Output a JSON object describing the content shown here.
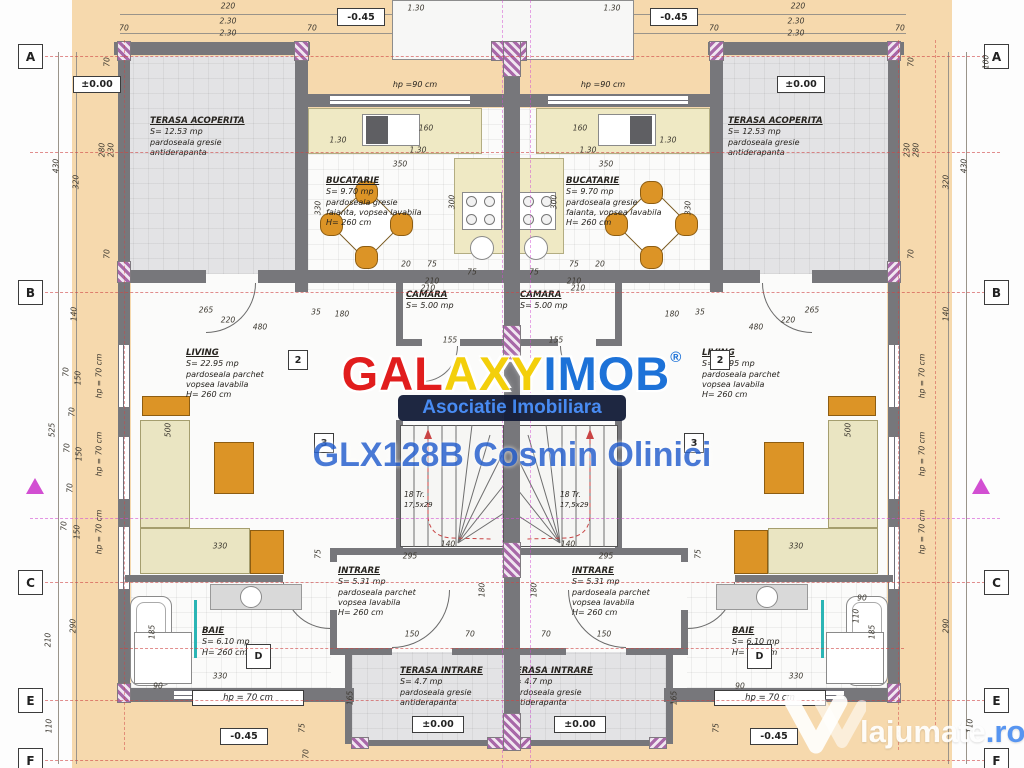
{
  "plan": {
    "rooms": {
      "terasa_acoperita": {
        "name": "TERASA ACOPERITA",
        "area": "S= 12.53 mp",
        "note1": "pardoseala gresie",
        "note2": "antiderapanta"
      },
      "bucatarie": {
        "name": "BUCATARIE",
        "area": "S= 9.70 mp",
        "note1": "pardoseala gresie",
        "note2": "faianta, vopsea lavabila",
        "note3": "H= 260 cm"
      },
      "camara": {
        "name": "CAMARA",
        "area": "S= 5.00 mp"
      },
      "living": {
        "name": "LIVING",
        "area": "S= 22.95 mp",
        "note1": "pardoseala parchet",
        "note2": "vopsea lavabila",
        "note3": "H= 260 cm"
      },
      "intrare": {
        "name": "INTRARE",
        "area": "S= 5.31 mp",
        "note1": "pardoseala parchet",
        "note2": "vopsea lavabila",
        "note3": "H= 260 cm"
      },
      "baie": {
        "name": "BAIE",
        "area": "S= 6.10 mp",
        "note1": "H= 260 cm"
      },
      "terasa_intrare": {
        "name": "TERASA INTRARE",
        "area": "S= 4.7 mp",
        "note1": "pardoseala gresie",
        "note2": "antiderapanta"
      }
    },
    "stairs": {
      "steps": "18 Tr.",
      "riser": "17,5x29"
    },
    "elevations": {
      "zero": "±0.00",
      "minus": "-0.45"
    },
    "sills": {
      "hp90": "hp =90 cm",
      "hp70": "hp = 70 cm"
    },
    "grid": {
      "left": [
        "A",
        "B",
        "C",
        "E",
        "F"
      ],
      "right": [
        "A",
        "B",
        "C",
        "E",
        "F"
      ],
      "bath": "D"
    },
    "markers": {
      "m2": "2",
      "m3": "3"
    },
    "dimensions": [
      {
        "t": "220",
        "x": 228,
        "y": 6
      },
      {
        "t": "70",
        "x": 124,
        "y": 28
      },
      {
        "t": "2.30",
        "x": 228,
        "y": 21
      },
      {
        "t": "2.30",
        "x": 228,
        "y": 33
      },
      {
        "t": "70",
        "x": 312,
        "y": 28
      },
      {
        "t": "1.30",
        "x": 416,
        "y": 8
      },
      {
        "t": "1.30",
        "x": 612,
        "y": 8
      },
      {
        "t": "70",
        "x": 714,
        "y": 28
      },
      {
        "t": "2.30",
        "x": 796,
        "y": 21
      },
      {
        "t": "2.30",
        "x": 796,
        "y": 33
      },
      {
        "t": "70",
        "x": 900,
        "y": 28
      },
      {
        "t": "220",
        "x": 798,
        "y": 6
      },
      {
        "t": "430",
        "x": 56,
        "y": 166,
        "r": 1
      },
      {
        "t": "320",
        "x": 76,
        "y": 182,
        "r": 1
      },
      {
        "t": "280",
        "x": 102,
        "y": 150,
        "r": 1
      },
      {
        "t": "230",
        "x": 111,
        "y": 150,
        "r": 1
      },
      {
        "t": "70",
        "x": 107,
        "y": 62,
        "r": 1
      },
      {
        "t": "70",
        "x": 107,
        "y": 254,
        "r": 1
      },
      {
        "t": "140",
        "x": 74,
        "y": 314,
        "r": 1
      },
      {
        "t": "70",
        "x": 66,
        "y": 372,
        "r": 1
      },
      {
        "t": "150",
        "x": 78,
        "y": 378,
        "r": 1
      },
      {
        "t": "70",
        "x": 72,
        "y": 412,
        "r": 1
      },
      {
        "t": "525",
        "x": 52,
        "y": 430,
        "r": 1
      },
      {
        "t": "70",
        "x": 67,
        "y": 448,
        "r": 1
      },
      {
        "t": "150",
        "x": 79,
        "y": 454,
        "r": 1
      },
      {
        "t": "70",
        "x": 70,
        "y": 488,
        "r": 1
      },
      {
        "t": "70",
        "x": 64,
        "y": 526,
        "r": 1
      },
      {
        "t": "150",
        "x": 77,
        "y": 532,
        "r": 1
      },
      {
        "t": "210",
        "x": 48,
        "y": 640,
        "r": 1
      },
      {
        "t": "290",
        "x": 73,
        "y": 626,
        "r": 1
      },
      {
        "t": "110",
        "x": 49,
        "y": 726,
        "r": 1
      },
      {
        "t": "hp = 70 cm",
        "x": 99,
        "y": 376,
        "r": 1
      },
      {
        "t": "hp = 70 cm",
        "x": 99,
        "y": 454,
        "r": 1
      },
      {
        "t": "hp = 70 cm",
        "x": 99,
        "y": 532,
        "r": 1
      },
      {
        "t": "100",
        "x": 986,
        "y": 62,
        "r": 1
      },
      {
        "t": "430",
        "x": 964,
        "y": 166,
        "r": 1
      },
      {
        "t": "320",
        "x": 946,
        "y": 182,
        "r": 1
      },
      {
        "t": "280",
        "x": 916,
        "y": 150,
        "r": 1
      },
      {
        "t": "230",
        "x": 907,
        "y": 150,
        "r": 1
      },
      {
        "t": "70",
        "x": 911,
        "y": 62,
        "r": 1
      },
      {
        "t": "70",
        "x": 911,
        "y": 254,
        "r": 1
      },
      {
        "t": "140",
        "x": 946,
        "y": 314,
        "r": 1
      },
      {
        "t": "290",
        "x": 946,
        "y": 626,
        "r": 1
      },
      {
        "t": "110",
        "x": 970,
        "y": 726,
        "r": 1
      },
      {
        "t": "hp = 70 cm",
        "x": 922,
        "y": 376,
        "r": 1
      },
      {
        "t": "hp = 70 cm",
        "x": 922,
        "y": 454,
        "r": 1
      },
      {
        "t": "hp = 70 cm",
        "x": 922,
        "y": 532,
        "r": 1
      },
      {
        "t": "1.30",
        "x": 338,
        "y": 140
      },
      {
        "t": "160",
        "x": 426,
        "y": 128
      },
      {
        "t": "1.30",
        "x": 418,
        "y": 150
      },
      {
        "t": "350",
        "x": 400,
        "y": 164
      },
      {
        "t": "300",
        "x": 452,
        "y": 202,
        "r": 1
      },
      {
        "t": "330",
        "x": 318,
        "y": 208,
        "r": 1
      },
      {
        "t": "20",
        "x": 406,
        "y": 264
      },
      {
        "t": "75",
        "x": 432,
        "y": 264
      },
      {
        "t": "75",
        "x": 472,
        "y": 272
      },
      {
        "t": "210",
        "x": 432,
        "y": 281
      },
      {
        "t": "1.30",
        "x": 668,
        "y": 140
      },
      {
        "t": "160",
        "x": 580,
        "y": 128
      },
      {
        "t": "1.30",
        "x": 588,
        "y": 150
      },
      {
        "t": "350",
        "x": 606,
        "y": 164
      },
      {
        "t": "300",
        "x": 554,
        "y": 202,
        "r": 1
      },
      {
        "t": "330",
        "x": 688,
        "y": 208,
        "r": 1
      },
      {
        "t": "20",
        "x": 600,
        "y": 264
      },
      {
        "t": "75",
        "x": 574,
        "y": 264
      },
      {
        "t": "75",
        "x": 534,
        "y": 272
      },
      {
        "t": "210",
        "x": 574,
        "y": 281
      },
      {
        "t": "210",
        "x": 428,
        "y": 288
      },
      {
        "t": "155",
        "x": 450,
        "y": 340
      },
      {
        "t": "210",
        "x": 578,
        "y": 288
      },
      {
        "t": "155",
        "x": 556,
        "y": 340
      },
      {
        "t": "265",
        "x": 206,
        "y": 310
      },
      {
        "t": "220",
        "x": 228,
        "y": 320
      },
      {
        "t": "480",
        "x": 260,
        "y": 327
      },
      {
        "t": "35",
        "x": 316,
        "y": 312
      },
      {
        "t": "180",
        "x": 342,
        "y": 314
      },
      {
        "t": "500",
        "x": 168,
        "y": 430,
        "r": 1
      },
      {
        "t": "330",
        "x": 220,
        "y": 546
      },
      {
        "t": "75",
        "x": 318,
        "y": 554,
        "r": 1
      },
      {
        "t": "265",
        "x": 812,
        "y": 310
      },
      {
        "t": "220",
        "x": 788,
        "y": 320
      },
      {
        "t": "480",
        "x": 756,
        "y": 327
      },
      {
        "t": "35",
        "x": 700,
        "y": 312
      },
      {
        "t": "180",
        "x": 672,
        "y": 314
      },
      {
        "t": "500",
        "x": 848,
        "y": 430,
        "r": 1
      },
      {
        "t": "330",
        "x": 796,
        "y": 546
      },
      {
        "t": "75",
        "x": 698,
        "y": 554,
        "r": 1
      },
      {
        "t": "295",
        "x": 410,
        "y": 556
      },
      {
        "t": "140",
        "x": 448,
        "y": 544
      },
      {
        "t": "180",
        "x": 482,
        "y": 590,
        "r": 1
      },
      {
        "t": "150",
        "x": 412,
        "y": 634
      },
      {
        "t": "70",
        "x": 470,
        "y": 634
      },
      {
        "t": "295",
        "x": 606,
        "y": 556
      },
      {
        "t": "140",
        "x": 568,
        "y": 544
      },
      {
        "t": "180",
        "x": 534,
        "y": 590,
        "r": 1
      },
      {
        "t": "150",
        "x": 604,
        "y": 634
      },
      {
        "t": "70",
        "x": 546,
        "y": 634
      },
      {
        "t": "330",
        "x": 220,
        "y": 676
      },
      {
        "t": "90",
        "x": 158,
        "y": 686
      },
      {
        "t": "185",
        "x": 152,
        "y": 632,
        "r": 1
      },
      {
        "t": "330",
        "x": 796,
        "y": 676
      },
      {
        "t": "90",
        "x": 740,
        "y": 686
      },
      {
        "t": "185",
        "x": 872,
        "y": 632,
        "r": 1
      },
      {
        "t": "110",
        "x": 856,
        "y": 616,
        "r": 1
      },
      {
        "t": "90",
        "x": 862,
        "y": 598
      },
      {
        "t": "165",
        "x": 350,
        "y": 698,
        "r": 1
      },
      {
        "t": "165",
        "x": 674,
        "y": 698,
        "r": 1
      },
      {
        "t": "75",
        "x": 302,
        "y": 728,
        "r": 1
      },
      {
        "t": "70",
        "x": 306,
        "y": 754,
        "r": 1
      },
      {
        "t": "75",
        "x": 716,
        "y": 728,
        "r": 1
      }
    ]
  },
  "watermarks": {
    "galaxyimob": {
      "part1": "GAL",
      "part2": "AXY",
      "part3": "IMOB",
      "reg": "®",
      "subtitle": "Asociatie Imobiliara",
      "code_line": "GLX128B Cosmin Olinici",
      "colors": {
        "part1": "#e11d1d",
        "part2": "#f3cf0b",
        "part3": "#1d72d8",
        "band_bg": "#131c38",
        "subtitle": "#3f86f2",
        "code": "#2a63cf"
      }
    },
    "lajumate": {
      "name": "lajumate",
      "tld": ".ro",
      "text_color": "#ffffff",
      "tld_color": "#4a8df0"
    }
  },
  "palette": {
    "paper": "#f6d9ad",
    "margin": "#fdfdfd",
    "wall": "#77777b",
    "terrace_floor": "#e3e3e5",
    "interior": "#fbfbfa",
    "counter": "#efe9c4",
    "furniture_orange": "#dc9426",
    "furniture_cream": "#eae5c2",
    "axis_red": "#cf4444",
    "axis_magenta": "#d24fd2"
  }
}
